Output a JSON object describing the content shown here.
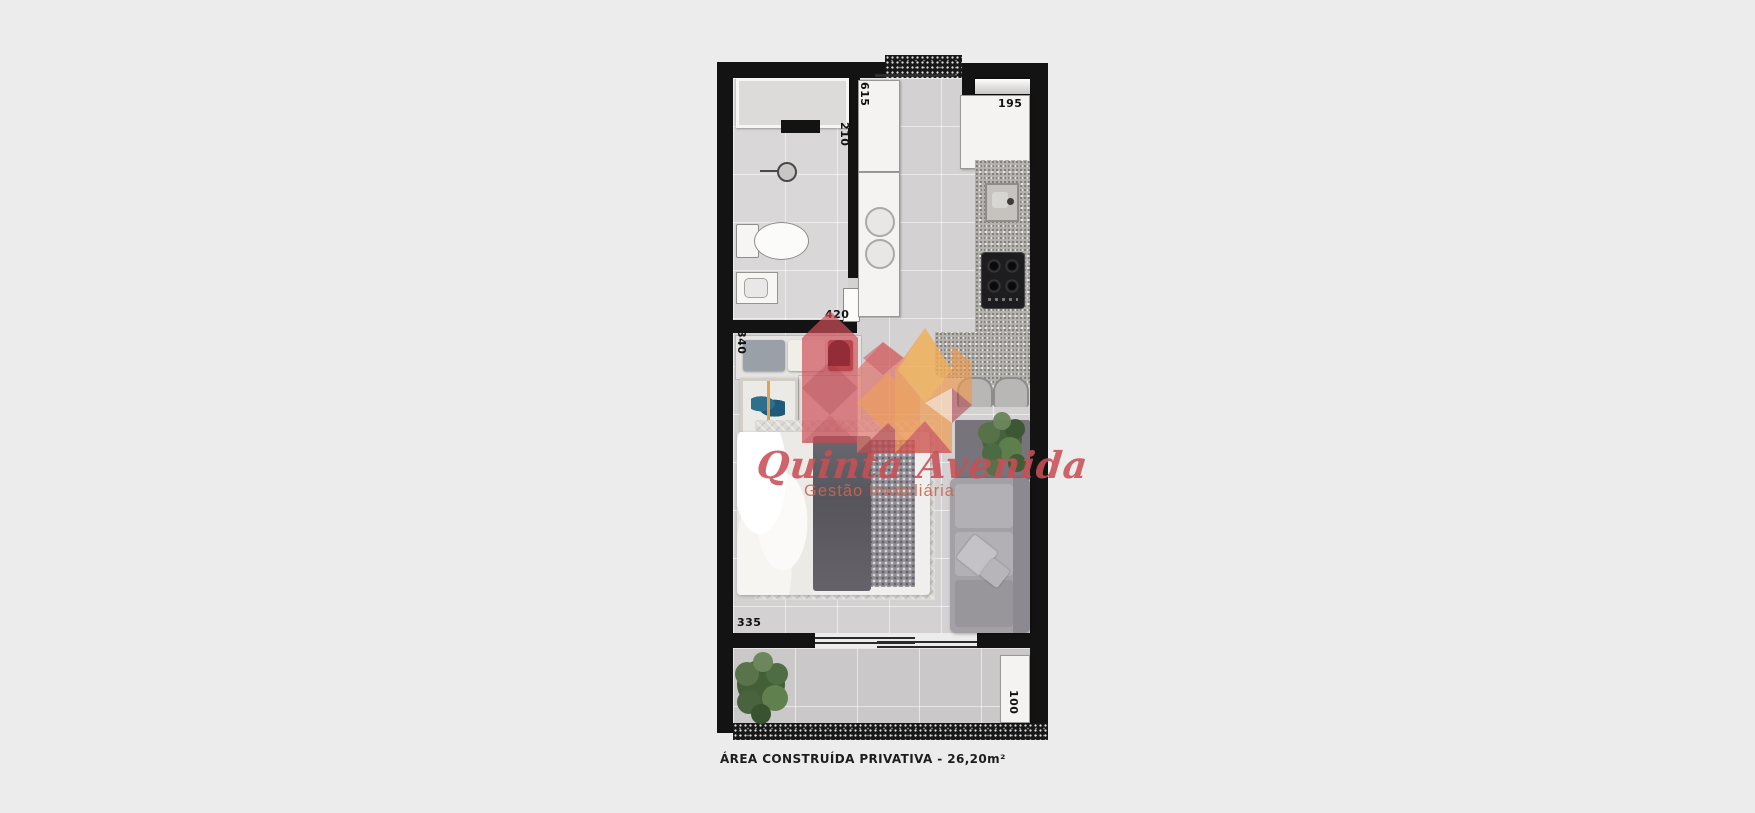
{
  "page": {
    "caption": "ÁREA CONSTRUÍDA PRIVATIVA - 26,20m²",
    "background_color": "#ececec"
  },
  "watermark": {
    "brand": "Quinta Avenida",
    "tagline": "Gestão Imobiliária",
    "brand_color": "#c84e55",
    "tagline_color": "#c8674f",
    "shape_colors": [
      "#cf5058",
      "#e0746c",
      "#ee8e4d",
      "#f3b055",
      "#b2434c",
      "#8e2a34"
    ]
  },
  "dimensions": {
    "entry_depth": "615",
    "hall_width": "210",
    "kitchen_width": "195",
    "bedroom_width": "420",
    "closet_width": "340",
    "bedroom_length": "335",
    "balcony_depth": "100"
  },
  "plan_colors": {
    "wall": "#131313",
    "floor": "#d3d1d1",
    "balcony_floor": "#cac8c8",
    "counter_granite": "#b5b2ae"
  }
}
